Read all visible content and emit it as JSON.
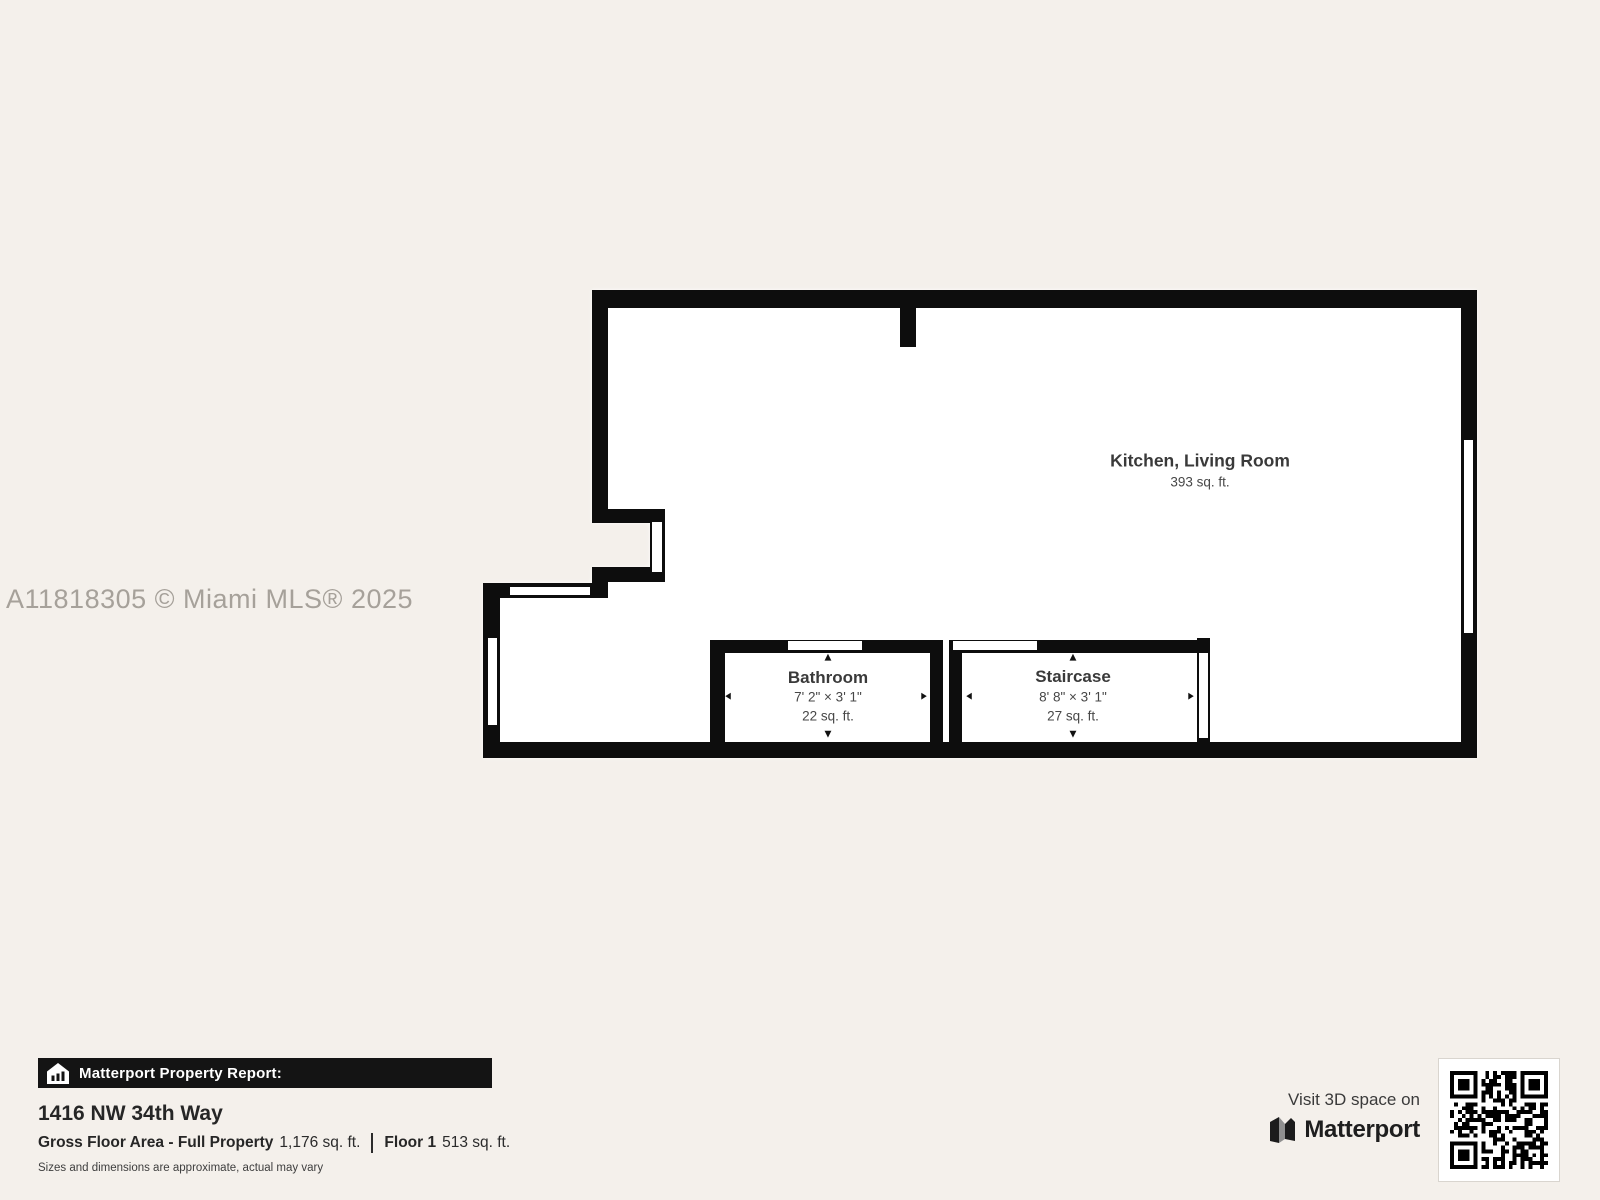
{
  "watermark": "A11818305 © Miami MLS® 2025",
  "floor_plan": {
    "rooms": [
      {
        "name": "Kitchen, Living Room",
        "area": "393 sq. ft."
      },
      {
        "name": "Bathroom",
        "dimensions": "7' 2\" × 3' 1\"",
        "area": "22 sq. ft."
      },
      {
        "name": "Staircase",
        "dimensions": "8' 8\" × 3' 1\"",
        "area": "27 sq. ft."
      }
    ],
    "arrows": {
      "up": "▲",
      "down": "▼",
      "left": "◀",
      "right": "▶"
    }
  },
  "report": {
    "header": "Matterport Property Report:",
    "address": "1416 NW 34th Way",
    "gross_label": "Gross Floor Area - Full Property",
    "gross_value": "1,176 sq. ft.",
    "floor_label": "Floor 1",
    "floor_value": "513 sq. ft.",
    "disclaimer": "Sizes and dimensions are approximate, actual may vary"
  },
  "cta": {
    "visit_text": "Visit 3D space on",
    "brand": "Matterport"
  },
  "icons": {
    "house": "house-report-icon",
    "logo": "matterport-logo-icon",
    "qr": "qr-code"
  },
  "colors": {
    "background": "#f4f0eb",
    "wall": "#0d0d0d",
    "interior": "#ffffff",
    "watermark": "#a6a19a",
    "report_bar": "#141414"
  }
}
